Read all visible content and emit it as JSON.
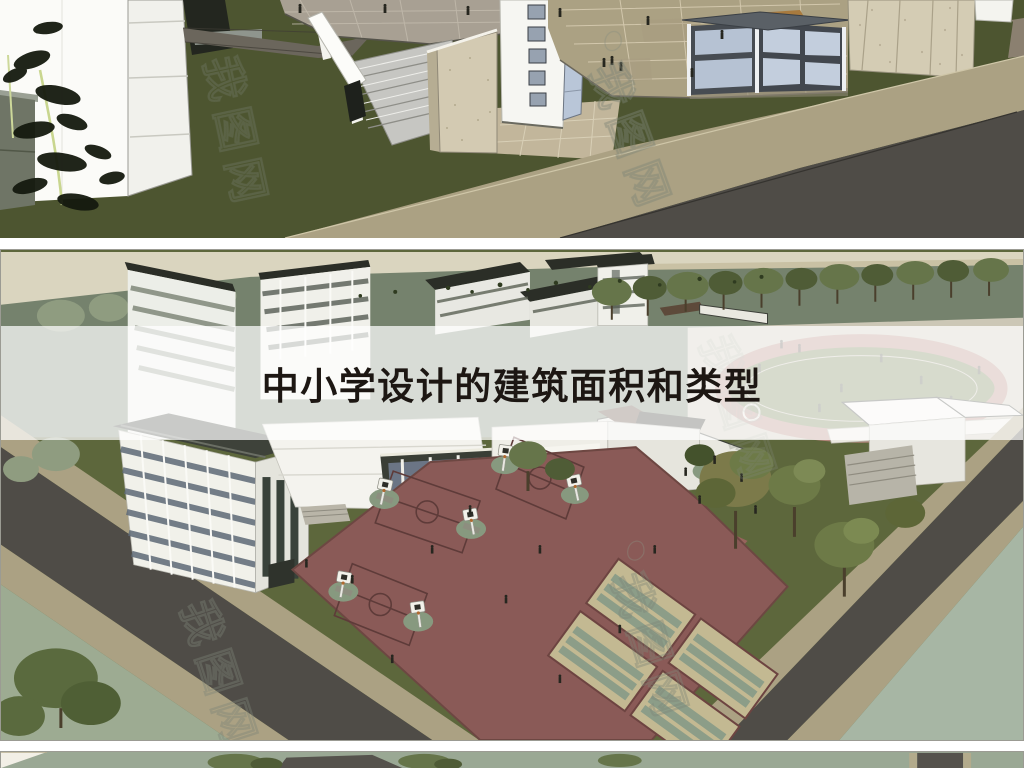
{
  "title_banner": {
    "text": "中小学设计的建筑面积和类型",
    "text_color": "#1d1713",
    "background": "rgba(255,255,255,0.72)"
  },
  "watermark": {
    "text": "我图网",
    "color": "#8a8a8a"
  },
  "sections": [
    {
      "id": "entrance",
      "description": "3D render of school entrance plaza with glass gatehouse, stone walls, white tower, bamboo and lawn"
    },
    {
      "id": "campus",
      "description": "Aerial 3D render of school campus with classroom buildings, running track, basketball and volleyball courts"
    },
    {
      "id": "strip",
      "description": "Top sliver of a third campus render"
    }
  ],
  "palette": {
    "lawn_dark": "#4d5530",
    "lawn": "#5d673c",
    "field": "#75826d",
    "beige": "#dad5bf",
    "road": "#4f4c47",
    "sidewalk": "#aba183",
    "court_maroon": "#8a5a57",
    "court_pad": "#87997f",
    "volleyball_tan": "#c3b992",
    "track_red": "#b2857a",
    "water": "#a7b6a4",
    "plaza": "#ccc7b6",
    "building_white": "#f4f3ee",
    "roof_dark": "#2b2e27",
    "glass_blue": "#b6c2d3",
    "stone": "#d4ccb4",
    "title_color": "#1d1713"
  }
}
